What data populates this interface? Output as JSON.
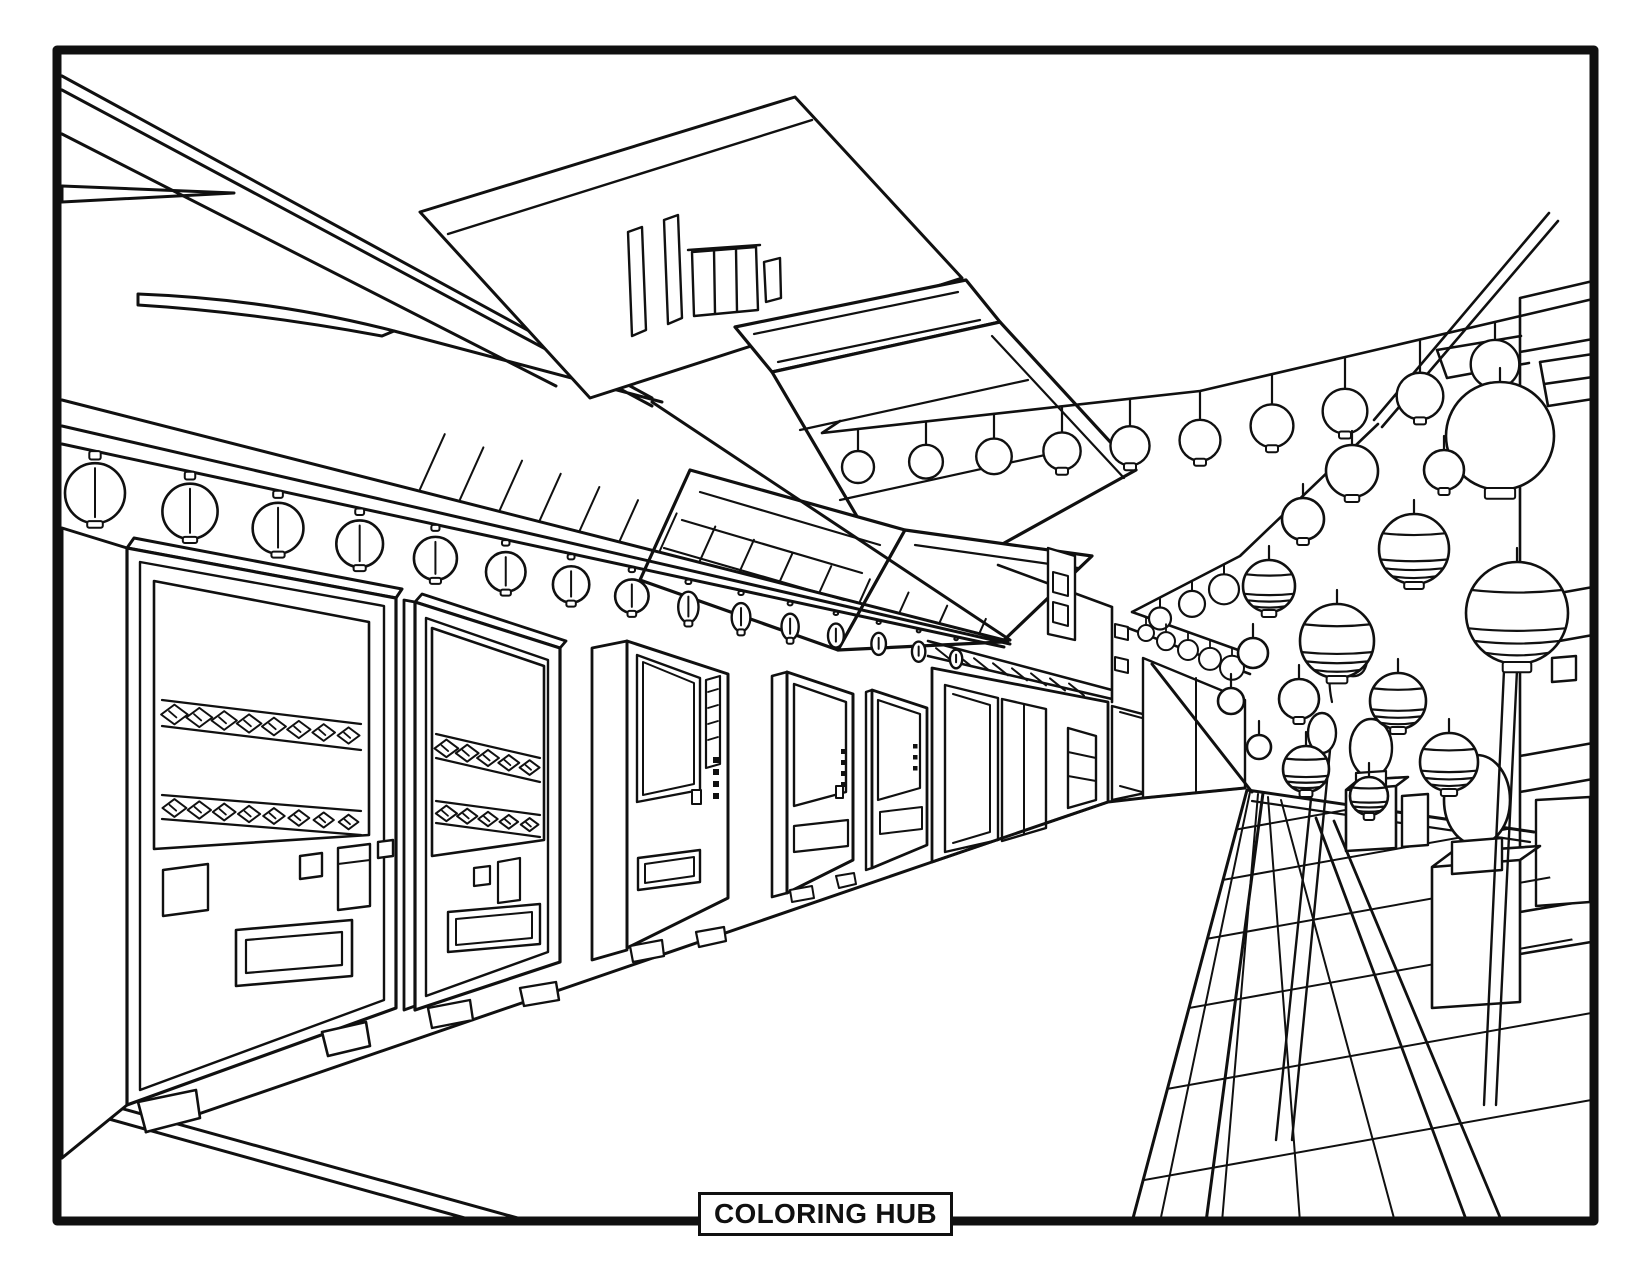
{
  "page": {
    "background_color": "#ffffff",
    "line_color": "#101010",
    "footer_badge": "COLORING HUB"
  },
  "scene": {
    "style": "black-and-white line-art coloring page",
    "setting": "Japanese shopping street in one-point perspective",
    "elements": [
      "page frame border",
      "diagonal roof beams top-left",
      "storefront awning with garland of round paper lanterns",
      "row of vending machines with spiral product racks",
      "traditional gabled temple roof",
      "modern background building with rooftop structure",
      "distant shopfronts with sliding doors",
      "strings of paper lanterns crossing the street",
      "cluster of striped paper lanterns on the right",
      "stone lanterns on pedestals",
      "checkerboard tiled walkway",
      "street receding to a vanishing point"
    ]
  }
}
